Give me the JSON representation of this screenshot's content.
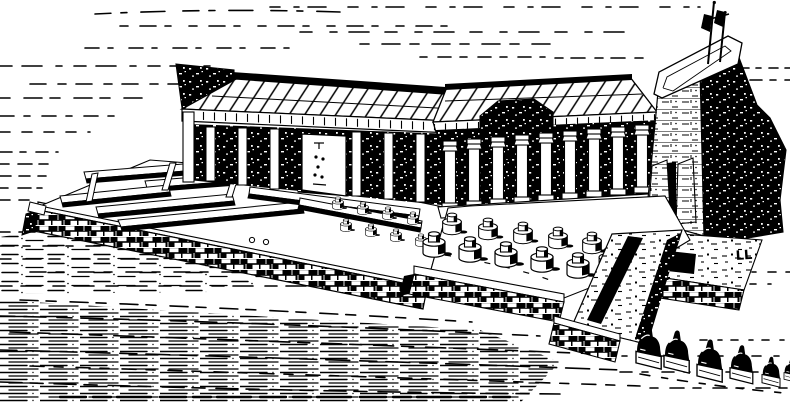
{
  "figure": {
    "alt": "Black-and-white engraving: bird's-eye reconstruction of an ancient Egyptian temple complex with a rear ruined court, a roofed inner hall, a hypostyle colonnade, a tall pylon with two flag masts, a forecourt of truncated column stumps, a descending causeway and an avenue of sphinxes",
    "signature": "LL"
  },
  "palette": {
    "ink": "#000000",
    "paper": "#ffffff"
  }
}
